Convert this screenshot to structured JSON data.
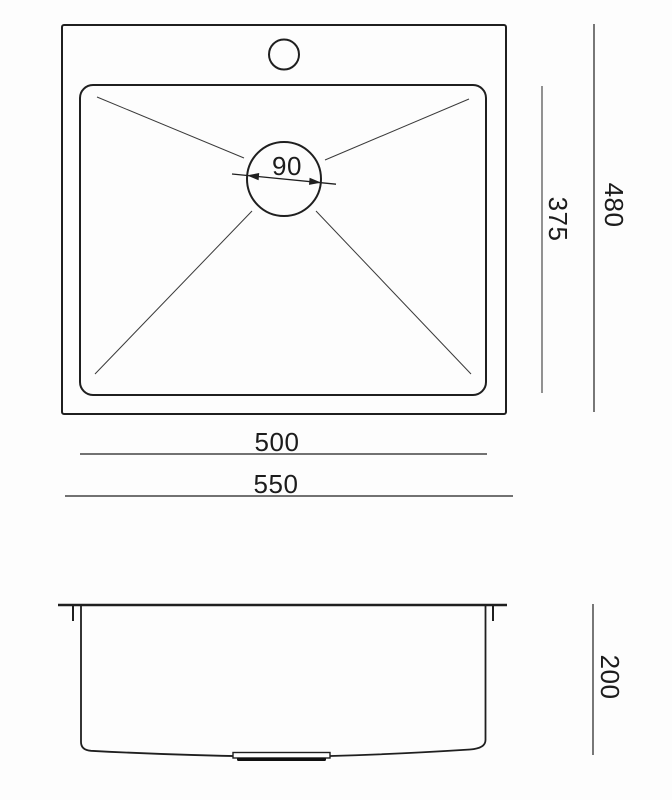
{
  "drawing": {
    "type": "technical-dimension-drawing",
    "subject": "kitchen sink",
    "colors": {
      "line": "#1f1f1f",
      "background": "#ffffff"
    },
    "top_view": {
      "labels": {
        "drain_diameter": "90",
        "bowl_length": "375",
        "overall_length": "480",
        "bowl_width": "500",
        "overall_width": "550"
      }
    },
    "side_view": {
      "labels": {
        "depth": "200"
      }
    }
  }
}
